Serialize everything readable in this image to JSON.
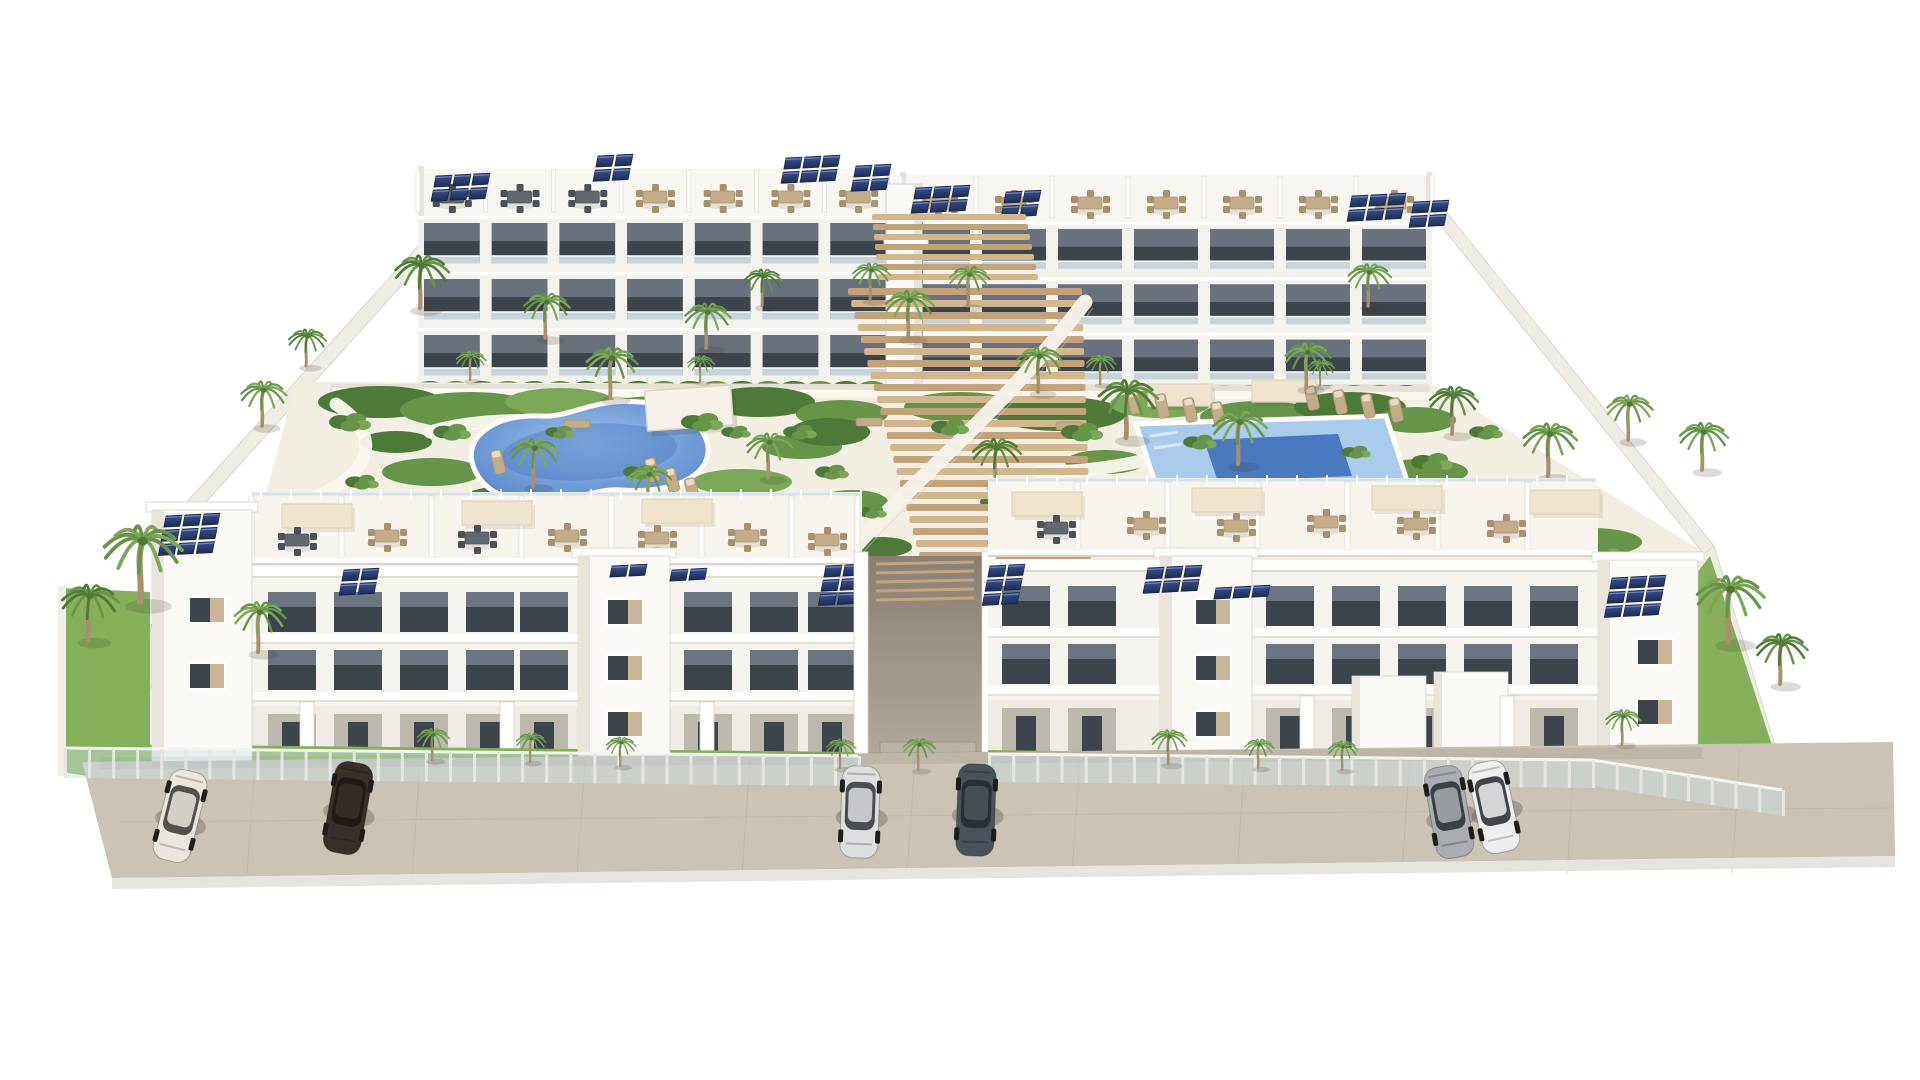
{
  "meta": {
    "title": "Aerial 3D architectural rendering of a white modern apartment complex with two swimming pools, palm gardens, rooftop solar panels and parked cars",
    "canvas": {
      "w": 1920,
      "h": 1080
    }
  },
  "palette": {
    "bg": "#ffffff",
    "bldg": "#f7f5f0",
    "bldgFace": "#fbfaf7",
    "bldgShade": "#e8e4db",
    "bldgDark": "#d9d4c9",
    "winDark": "#3e444b",
    "winGlass": "#78828c",
    "glassRail": "#d5e4e9",
    "solar": "#2a3a66",
    "solarDark": "#1b2749",
    "solarLight": "#6d83c4",
    "poolLight": "#a9cbec",
    "poolMid": "#6b96d4",
    "poolDeep": "#4b79c0",
    "deck": "#f3eee2",
    "path": "#faf7ef",
    "grass": "#85af5a",
    "grassDark": "#5d8a40",
    "green1": "#4d7a38",
    "green2": "#669449",
    "green3": "#7ba858",
    "trunk": "#a6906e",
    "wood1": "#d2b68e",
    "wood2": "#c2a379",
    "pave": "#cbc3b5",
    "paveSeam": "#b5ac9c",
    "curb": "#e6e4e0",
    "furnTan": "#c3ad88",
    "furnTanDark": "#a8926d",
    "furnGray": "#62686f",
    "furnGrayDark": "#4c5157",
    "canopy": "#eee3cd",
    "canopyEdge": "#e0d4ba",
    "wall": "#efece6",
    "wallShade": "#dcd7cc",
    "shadow": "rgba(60,55,45,0.16)"
  },
  "street": {
    "pavement": [
      [
        82,
        762
      ],
      [
        1893,
        742
      ],
      [
        1895,
        856
      ],
      [
        112,
        878
      ]
    ],
    "curb": [
      [
        112,
        878
      ],
      [
        1895,
        856
      ],
      [
        1895,
        867
      ],
      [
        112,
        889
      ]
    ],
    "shadow_strip": [
      [
        100,
        757
      ],
      [
        1702,
        747
      ],
      [
        1702,
        759
      ],
      [
        100,
        769
      ]
    ],
    "seam_xs": [
      255,
      420,
      585,
      750,
      915,
      1080,
      1245,
      1410,
      1575,
      1740
    ],
    "seam_y": 822
  },
  "cars": [
    {
      "x": 180,
      "y": 816,
      "rot": 14,
      "body": "#eae5dd",
      "glass": "#45443f"
    },
    {
      "x": 348,
      "y": 808,
      "rot": 10,
      "body": "#383028",
      "glass": "#1e1a16"
    },
    {
      "x": 860,
      "y": 812,
      "rot": 2,
      "body": "#dcdee0",
      "glass": "#3c4146"
    },
    {
      "x": 976,
      "y": 810,
      "rot": 2,
      "body": "#4a525c",
      "glass": "#272d33"
    },
    {
      "x": 1449,
      "y": 812,
      "rot": -10,
      "body": "#a9acb0",
      "glass": "#32363a"
    },
    {
      "x": 1494,
      "y": 807,
      "rot": -12,
      "body": "#eceef0",
      "glass": "#33373c"
    }
  ],
  "perimeter": {
    "walls": [
      [
        [
          418,
          246
        ],
        [
          430,
          254
        ],
        [
          188,
          522
        ],
        [
          176,
          514
        ]
      ],
      [
        [
          176,
          514
        ],
        [
          188,
          522
        ],
        [
          134,
          762
        ],
        [
          122,
          758
        ]
      ],
      [
        [
          1430,
          212
        ],
        [
          1440,
          204
        ],
        [
          1714,
          546
        ],
        [
          1704,
          554
        ]
      ],
      [
        [
          1704,
          554
        ],
        [
          1714,
          546
        ],
        [
          1788,
          788
        ],
        [
          1778,
          794
        ]
      ]
    ],
    "gate_box": {
      "x": 284,
      "y": 466,
      "w": 68,
      "h": 58
    }
  },
  "back_row": {
    "blocks": [
      {
        "x0": 418,
        "x1": 892,
        "roofY": 166,
        "facadeY": 216,
        "baseY": 384,
        "bays": 7,
        "furn": [
          "gray",
          "gray",
          "gray",
          "tan",
          "tan",
          "tan",
          "tan"
        ]
      },
      {
        "x0": 900,
        "x1": 1432,
        "roofY": 172,
        "facadeY": 222,
        "baseY": 388,
        "bays": 7,
        "furn": [
          "tan",
          "tan",
          "tan",
          "tan",
          "tan",
          "tan",
          "tan"
        ]
      }
    ],
    "center_tower": {
      "x": 886,
      "y": 184,
      "w": 36,
      "h": 208
    },
    "gap_green": {
      "x": 893,
      "y": 222,
      "w": 30,
      "h": 150
    },
    "bridge": {
      "x": 884,
      "y": 238,
      "w": 44,
      "h": 9
    },
    "solar": [
      {
        "x": 436,
        "y": 176,
        "r": 2,
        "c": 3
      },
      {
        "x": 598,
        "y": 156,
        "r": 2,
        "c": 2
      },
      {
        "x": 786,
        "y": 158,
        "r": 2,
        "c": 3
      },
      {
        "x": 856,
        "y": 166,
        "r": 2,
        "c": 2
      },
      {
        "x": 916,
        "y": 188,
        "r": 2,
        "c": 3
      },
      {
        "x": 1006,
        "y": 192,
        "r": 2,
        "c": 2
      },
      {
        "x": 1352,
        "y": 196,
        "r": 2,
        "c": 3
      },
      {
        "x": 1414,
        "y": 202,
        "r": 2,
        "c": 2
      }
    ]
  },
  "courtyard": {
    "deck": [
      [
        296,
        382
      ],
      [
        1436,
        386
      ],
      [
        1716,
        560
      ],
      [
        1650,
        640
      ],
      [
        238,
        598
      ]
    ],
    "walk": [
      [
        332,
        388
      ],
      [
        1430,
        392
      ],
      [
        1438,
        400
      ],
      [
        334,
        396
      ]
    ],
    "beds": [
      [
        380,
        402,
        62,
        16,
        1
      ],
      [
        470,
        410,
        70,
        18,
        2
      ],
      [
        560,
        402,
        55,
        14,
        3
      ],
      [
        660,
        412,
        66,
        16,
        2
      ],
      [
        760,
        402,
        55,
        15,
        1
      ],
      [
        842,
        414,
        46,
        14,
        2
      ],
      [
        960,
        407,
        56,
        15,
        2
      ],
      [
        1060,
        414,
        66,
        17,
        1
      ],
      [
        1160,
        404,
        50,
        14,
        3
      ],
      [
        1260,
        417,
        60,
        16,
        2
      ],
      [
        1350,
        407,
        56,
        15,
        1
      ],
      [
        1416,
        420,
        40,
        13,
        2
      ],
      [
        432,
        472,
        50,
        14,
        2
      ],
      [
        520,
        500,
        60,
        15,
        1
      ],
      [
        642,
        507,
        56,
        14,
        2
      ],
      [
        742,
        482,
        50,
        13,
        3
      ],
      [
        802,
        447,
        40,
        12,
        2
      ],
      [
        396,
        442,
        36,
        11,
        1
      ],
      [
        1105,
        462,
        40,
        12,
        2
      ],
      [
        1035,
        502,
        55,
        14,
        1
      ],
      [
        1162,
        512,
        46,
        12,
        2
      ],
      [
        1422,
        472,
        46,
        13,
        2
      ],
      [
        1502,
        507,
        60,
        15,
        1
      ],
      [
        1592,
        542,
        50,
        14,
        2
      ],
      [
        830,
        432,
        40,
        14,
        1
      ],
      [
        852,
        502,
        36,
        12,
        2
      ],
      [
        882,
        547,
        30,
        10,
        1
      ]
    ],
    "paths": [
      "M336,404 C392,442 362,482 302,502",
      "M430,432 C480,417 560,417 620,430",
      "M1232,432 C1182,452 1122,472 1038,472",
      "M700,398 C720,420 700,440 670,444"
    ],
    "pool_left": {
      "d": "M472,462 C466,434 498,414 540,416 C566,418 584,404 616,402 C668,398 706,420 708,448 C710,476 672,494 622,490 C596,488 580,500 548,502 C502,505 478,486 472,462 Z",
      "cx": 589,
      "cy": 452
    },
    "pool_right": {
      "outer": [
        [
          1136,
          424
        ],
        [
          1386,
          416
        ],
        [
          1410,
          490
        ],
        [
          1160,
          498
        ]
      ],
      "deep": [
        [
          1204,
          440
        ],
        [
          1338,
          434
        ],
        [
          1352,
          476
        ],
        [
          1218,
          482
        ]
      ]
    },
    "stairs": {
      "yTop": 288,
      "yBot": 556,
      "step": 12,
      "upper": {
        "yTop": 214,
        "yBot": 282,
        "step": 10
      },
      "ramp": "M842,562 C905,485 995,420 1085,302"
    },
    "pergola": {
      "x": 646,
      "y": 388,
      "w": 86,
      "h": 40,
      "rot": -4
    },
    "canopies": [
      [
        1148,
        384,
        64,
        22
      ],
      [
        1252,
        380,
        64,
        22
      ]
    ],
    "loungers": [
      [
        652,
        470,
        -14
      ],
      [
        672,
        480,
        -14
      ],
      [
        692,
        490,
        -14
      ],
      [
        1134,
        402,
        -12
      ],
      [
        1162,
        406,
        -12
      ],
      [
        1190,
        410,
        -12
      ],
      [
        1218,
        414,
        -12
      ],
      [
        1312,
        398,
        -12
      ],
      [
        1340,
        402,
        -12
      ],
      [
        1368,
        406,
        -12
      ],
      [
        1396,
        410,
        -12
      ],
      [
        498,
        462,
        -14
      ]
    ],
    "benches": [
      [
        856,
        418
      ],
      [
        1056,
        422
      ],
      [
        564,
        420
      ]
    ]
  },
  "front_row": {
    "left": {
      "terrace": {
        "x0": 252,
        "x1": 862,
        "y0": 492,
        "y1": 564,
        "fins": [
          252,
          342,
          432,
          522,
          612,
          702,
          792,
          858
        ],
        "canopies": [
          [
            282,
            504
          ],
          [
            462,
            501
          ],
          [
            642,
            499
          ]
        ],
        "dining": [
          [
            297,
            540,
            "gray"
          ],
          [
            387,
            536,
            "tan"
          ],
          [
            477,
            538,
            "gray"
          ],
          [
            567,
            536,
            "tan"
          ],
          [
            657,
            538,
            "tan"
          ],
          [
            747,
            536,
            "tan"
          ],
          [
            827,
            540,
            "tan"
          ]
        ]
      },
      "towerA": {
        "x": 152,
        "y": 510,
        "w": 100,
        "h": 278,
        "solar": {
          "x": 166,
          "y": 516,
          "r": 3,
          "c": 3
        },
        "windows": [
          [
            190,
            598
          ],
          [
            190,
            664
          ]
        ]
      },
      "towerB": {
        "x": 578,
        "y": 556,
        "w": 92,
        "h": 232,
        "windows": [
          [
            608,
            600
          ],
          [
            608,
            656
          ],
          [
            608,
            712
          ]
        ]
      },
      "facades": [
        {
          "x0": 252,
          "x1": 578,
          "winXs": [
            268,
            334,
            400,
            466,
            520
          ]
        },
        {
          "x0": 670,
          "x1": 862,
          "winXs": [
            684,
            750,
            808
          ]
        }
      ],
      "parapetY": 566,
      "floor1Y": 592,
      "floor2Y": 650,
      "groundY": 706,
      "baseY": 770,
      "patio_walls": [
        300,
        500,
        700
      ],
      "lawn": [
        [
          106,
          744
        ],
        [
          860,
          752
        ],
        [
          860,
          790
        ],
        [
          106,
          786
        ]
      ],
      "left_garden": [
        [
          62,
          588
        ],
        [
          150,
          592
        ],
        [
          150,
          786
        ],
        [
          62,
          772
        ]
      ],
      "solar_mid": [
        {
          "x": 344,
          "y": 570,
          "r": 2,
          "c": 2
        },
        {
          "x": 612,
          "y": 566,
          "r": 1,
          "c": 2
        },
        {
          "x": 672,
          "y": 570,
          "r": 1,
          "c": 2
        },
        {
          "x": 826,
          "y": 566,
          "r": 3,
          "c": 2
        }
      ]
    },
    "passage": {
      "x0": 862,
      "x1": 988,
      "y0": 556,
      "y1": 772,
      "gate": [
        880,
        742,
        96,
        26
      ]
    },
    "right": {
      "terrace": {
        "x0": 988,
        "x1": 1598,
        "y0": 478,
        "y1": 556,
        "fins": [
          1078,
          1168,
          1258,
          1348,
          1438,
          1528
        ],
        "canopies": [
          [
            1012,
            492
          ],
          [
            1192,
            488
          ],
          [
            1372,
            486
          ],
          [
            1530,
            490
          ]
        ],
        "dining": [
          [
            1056,
            528,
            "gray"
          ],
          [
            1146,
            524,
            "tan"
          ],
          [
            1236,
            526,
            "tan"
          ],
          [
            1326,
            522,
            "tan"
          ],
          [
            1416,
            524,
            "tan"
          ],
          [
            1506,
            527,
            "tan"
          ]
        ]
      },
      "towerC": {
        "x": 1160,
        "y": 556,
        "w": 92,
        "h": 230,
        "windows": [
          [
            1196,
            600
          ],
          [
            1196,
            656
          ],
          [
            1196,
            712
          ]
        ]
      },
      "towerD": {
        "x": 1598,
        "y": 560,
        "w": 100,
        "h": 222,
        "solar": {
          "x": 1612,
          "y": 578,
          "r": 3,
          "c": 3
        },
        "windows": [
          [
            1638,
            640
          ],
          [
            1638,
            700
          ]
        ]
      },
      "facades": [
        {
          "x0": 988,
          "x1": 1160,
          "winXs": [
            1002,
            1068
          ]
        },
        {
          "x0": 1252,
          "x1": 1598,
          "winXs": [
            1266,
            1332,
            1398,
            1464,
            1530
          ]
        }
      ],
      "parapetY": 560,
      "floor1Y": 586,
      "floor2Y": 644,
      "groundY": 700,
      "baseY": 766,
      "white_walls": [
        [
          1352,
          676,
          74,
          90
        ],
        [
          1434,
          672,
          74,
          94
        ]
      ],
      "patio_walls": [
        1300,
        1500
      ],
      "lawn": [
        [
          988,
          750
        ],
        [
          1592,
          758
        ],
        [
          1596,
          792
        ],
        [
          988,
          792
        ]
      ],
      "right_garden": [
        [
          1598,
          700
        ],
        [
          1710,
          556
        ],
        [
          1786,
          788
        ],
        [
          1604,
          792
        ]
      ],
      "solar_mid": [
        {
          "x": 990,
          "y": 566,
          "r": 3,
          "c": 2
        },
        {
          "x": 1148,
          "y": 568,
          "r": 2,
          "c": 3
        },
        {
          "x": 1216,
          "y": 588,
          "r": 1,
          "c": 3
        }
      ]
    },
    "fences": [
      [
        64,
        748,
        858,
        756,
        30
      ],
      [
        988,
        754,
        1592,
        760,
        28
      ],
      [
        1592,
        760,
        1782,
        790,
        26
      ]
    ]
  },
  "palms": [
    [
      420,
      308,
      1.0,
      0
    ],
    [
      545,
      338,
      0.85,
      1
    ],
    [
      610,
      398,
      0.95,
      2
    ],
    [
      706,
      348,
      0.85,
      1
    ],
    [
      762,
      306,
      0.7,
      0
    ],
    [
      908,
      338,
      0.9,
      1
    ],
    [
      968,
      306,
      0.75,
      2
    ],
    [
      1038,
      392,
      0.85,
      1
    ],
    [
      1126,
      438,
      1.1,
      0
    ],
    [
      533,
      486,
      0.9,
      1
    ],
    [
      648,
      508,
      0.8,
      2
    ],
    [
      768,
      478,
      0.85,
      1
    ],
    [
      995,
      486,
      0.9,
      0
    ],
    [
      1238,
      464,
      1.0,
      1
    ],
    [
      1306,
      388,
      0.85,
      2
    ],
    [
      1368,
      306,
      0.8,
      1
    ],
    [
      1452,
      434,
      0.9,
      0
    ],
    [
      1548,
      476,
      1.0,
      1
    ],
    [
      1628,
      440,
      0.85,
      2
    ],
    [
      262,
      426,
      0.85,
      1
    ],
    [
      306,
      366,
      0.7,
      0
    ],
    [
      1702,
      470,
      0.9,
      1
    ],
    [
      870,
      300,
      0.7,
      1
    ],
    [
      470,
      380,
      0.55,
      2
    ],
    [
      700,
      382,
      0.5,
      1
    ],
    [
      1100,
      384,
      0.55,
      2
    ],
    [
      1320,
      386,
      0.5,
      1
    ],
    [
      140,
      602,
      1.45,
      1
    ],
    [
      88,
      640,
      1.05,
      0
    ],
    [
      258,
      652,
      0.95,
      2
    ],
    [
      1728,
      642,
      1.25,
      1
    ],
    [
      1780,
      684,
      0.95,
      0
    ],
    [
      432,
      760,
      0.6,
      1
    ],
    [
      530,
      762,
      0.55,
      2
    ],
    [
      620,
      766,
      0.55,
      1
    ],
    [
      840,
      768,
      0.55,
      1
    ],
    [
      918,
      770,
      0.6,
      2
    ],
    [
      1168,
      764,
      0.65,
      1
    ],
    [
      1258,
      768,
      0.55,
      2
    ],
    [
      1342,
      770,
      0.55,
      1
    ],
    [
      1622,
      744,
      0.65,
      1
    ]
  ],
  "bushes": [
    [
      350,
      422,
      1
    ],
    [
      452,
      432,
      0.9
    ],
    [
      702,
      422,
      1
    ],
    [
      800,
      432,
      0.8
    ],
    [
      950,
      427,
      0.9
    ],
    [
      1082,
      432,
      1
    ],
    [
      1200,
      442,
      0.8
    ],
    [
      1432,
      462,
      1
    ],
    [
      1522,
      522,
      1
    ],
    [
      1602,
      550,
      0.9
    ],
    [
      832,
      472,
      0.8
    ],
    [
      872,
      512,
      0.7
    ],
    [
      1112,
      502,
      0.8
    ],
    [
      640,
      472,
      0.8
    ],
    [
      560,
      432,
      0.7
    ],
    [
      362,
      482,
      0.8
    ],
    [
      736,
      432,
      0.7
    ],
    [
      1268,
      492,
      0.8
    ],
    [
      1356,
      452,
      0.7
    ],
    [
      1486,
      432,
      0.8
    ]
  ]
}
